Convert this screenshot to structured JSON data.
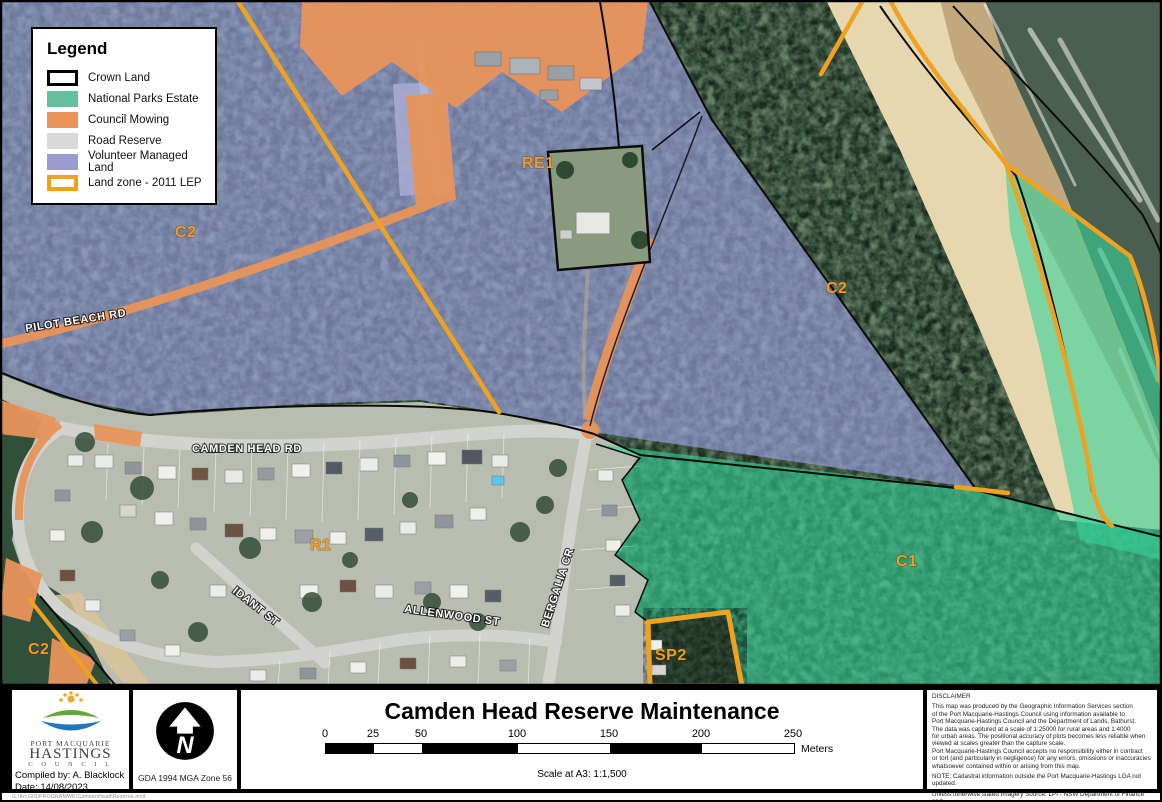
{
  "colors": {
    "national_parks": "#63c29d",
    "council_mowing": "#e8945a",
    "road_reserve": "#d9d9d9",
    "volunteer_land": "#9a9bd0",
    "lep_zone": "#efa21f",
    "label_orange": "#f29c1f"
  },
  "legend": {
    "title": "Legend",
    "items": [
      {
        "label": "Crown Land"
      },
      {
        "label": "National Parks Estate"
      },
      {
        "label": "Council Mowing"
      },
      {
        "label": "Road Reserve"
      },
      {
        "label": "Volunteer Managed Land"
      },
      {
        "label": "Land zone - 2011 LEP"
      }
    ]
  },
  "map": {
    "zone_labels": [
      {
        "text": "C2"
      },
      {
        "text": "RE1"
      },
      {
        "text": "C2"
      },
      {
        "text": "C1"
      },
      {
        "text": "R1"
      },
      {
        "text": "SP2"
      },
      {
        "text": "C2"
      }
    ],
    "road_labels": [
      {
        "text": "PILOT BEACH RD"
      },
      {
        "text": "CAMDEN HEAD RD"
      },
      {
        "text": "IDANT ST"
      },
      {
        "text": "ALLENWOOD ST"
      },
      {
        "text": "BERGALIA CR"
      }
    ]
  },
  "footer": {
    "title": "Camden Head Reserve Maintenance",
    "logo": {
      "line1": "PORT MACQUARIE",
      "line2": "HASTINGS",
      "line3": "C O U N C I L"
    },
    "compiled_by": "Compiled by: A. Blacklock",
    "date": "Date: 14/08/2023",
    "projection": "GDA 1994 MGA Zone 56",
    "scale_bar": {
      "ticks": [
        "0",
        "25",
        "50",
        "100",
        "150",
        "200",
        "250"
      ],
      "unit": "Meters",
      "scale_text": "Scale at A3: 1:1,500"
    },
    "disclaimer": {
      "heading": "DISCLAIMER",
      "para1": [
        "This map was produced by the Geographic Information Services section",
        "of the Port Macquarie-Hastings Council using information available to",
        "Port Macquarie-Hastings Council and the Department of Lands, Bathurst.",
        "The data was captured at a scale of 1:25000 for rural areas and 1:4000",
        "for urban areas. The positional accuracy of plots becomes less reliable when",
        "viewed at scales greater than the capture scale.",
        "Port Macquarie-Hastings Council accepts no responsibility either in contract",
        "or tort (and particularly in negligence) for any errors, omissions or inaccuracies",
        "whatsoever contained within or arising from this map."
      ],
      "note": "NOTE: Cadastral information outside the Port Macquarie-Hastings LGA not updated.",
      "para2": [
        "Unless otherwise stated Imagery Source: LPI - NSW Department of Finance and",
        "Services  2009, 2010, 2012 Panorama Avenue, Bathurst 2795 www.lpi.nsw.gov.au"
      ]
    },
    "file_path": "G:\\ArcGIS\\PROGRAMWK\\CamdenHead\\Reserve.mxd"
  }
}
